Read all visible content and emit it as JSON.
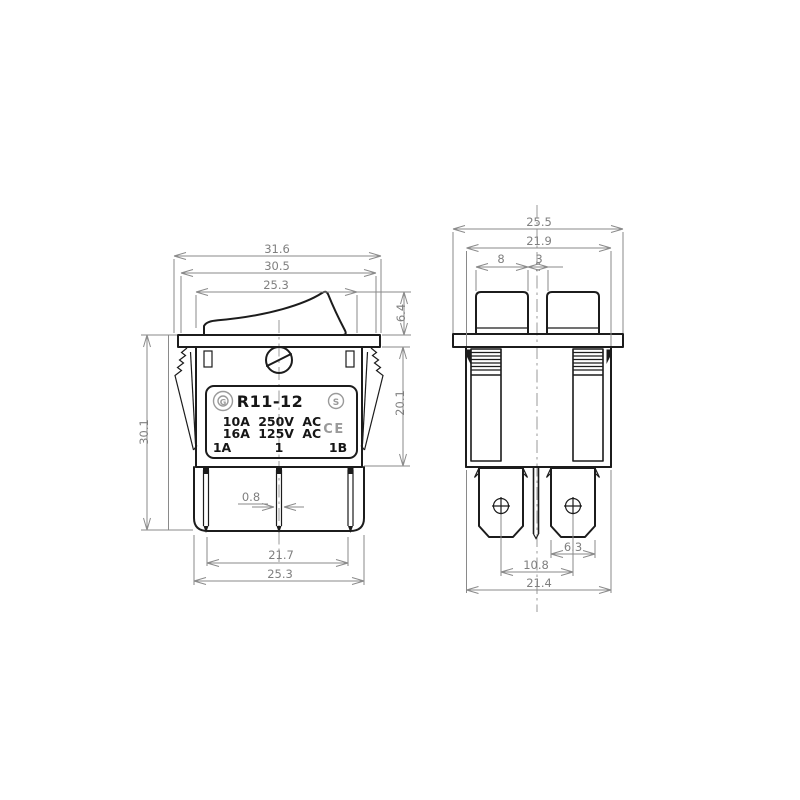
{
  "colors": {
    "background": "#ffffff",
    "outline": "#1c1c1c",
    "dimension_lines": "#8a8a8a",
    "label_gray": "#9a9a9a"
  },
  "front_view": {
    "name": "rocker-switch-front-view",
    "dimensions": {
      "flange_width": "31.6",
      "flange_top_width": "30.5",
      "rocker_width": "25.3",
      "rocker_height": "6.4",
      "overall_height": "30.1",
      "body_height": "20.1",
      "terminal_thickness": "0.8",
      "terminal_span": "21.7",
      "body_width": "25.3"
    },
    "label_plate": {
      "model": "R11-12",
      "rating_line1": "10A 250V AC",
      "rating_line2": "16A 125V AC",
      "terminal_marks": {
        "left": "1A",
        "center": "1",
        "right": "1B"
      },
      "cert_letters": {
        "left": "G",
        "right": "S"
      },
      "ce_mark": "CE"
    }
  },
  "side_view": {
    "name": "rocker-switch-side-view",
    "dimensions": {
      "flange_width": "25.5",
      "body_width": "21.9",
      "rocker_end_width": "8",
      "rocker_gap": "3",
      "terminal_boss_width": "6.3",
      "terminal_center_spacing": "10.8",
      "base_width": "21.4"
    }
  }
}
